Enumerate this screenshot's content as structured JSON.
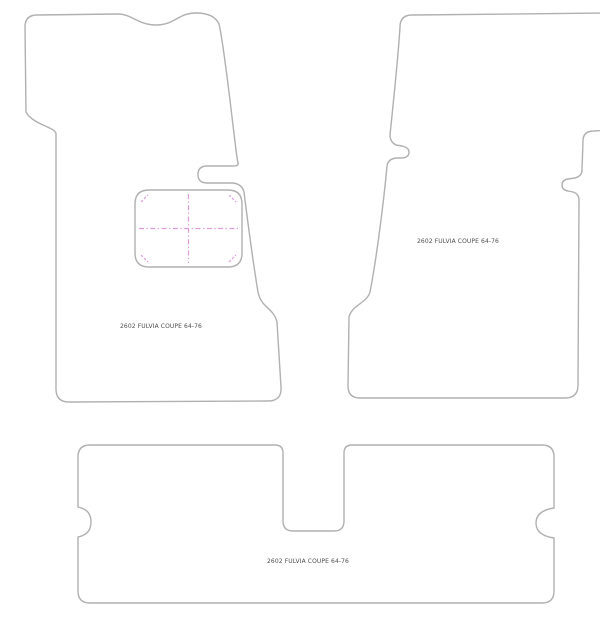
{
  "drawing": {
    "background_color": "#ffffff",
    "outline_color": "#b0b0b0",
    "marking_color": "#dd9add",
    "label_color": "#4d4d4d",
    "mats": {
      "front_left": {
        "label": "2602 FULVIA COUPE 64-76",
        "outline_path": "M 26,112 L 25,27 Q 25,15 37,15 L 118,14 C 132,14 138,25 156,25 C 175,25 178,13 196,13 Q 214,13 219,24 C 224,45 231,110 236,150 Q 237,158 238,163 Q 239,166 233,166 L 207,166 Q 198,166 198,174.5 Q 198,183 207,183 L 233,183 Q 242,184 244,192 C 248,224 253,262 258,292 C 261,308 273,307 277,322 L 281,387 Q 282,401 268,401 L 69,402 Q 56,402 56,389 L 56,134 C 56,127 33,125 26,112 Z",
        "heel_pad_path": "M 149,190 L 228,190 Q 242,190 242,204 L 242,253 Q 242,267 228,267 L 149,267 Q 135,267 135,253 L 135,204 Q 135,190 149,190 Z",
        "heel_pad_cross_path": "M 188.5,194 L 188.5,263 M 139,228.5 L 238,228.5",
        "heel_pad_tick_path": "M 141,202 L 148,195 M 229,195 L 236,202 M 141,255 L 148,262 M 229,262 L 236,255"
      },
      "front_right": {
        "label": "2602 FULVIA COUPE 64-76",
        "outline_path": "M 610,13 L 412,15 Q 400,15 400,27 C 398,60 392,115 390,135 Q 390,142 396,145 L 402,146 Q 409,147.5 409,152 Q 409,157.5 402,158 L 396,158 Q 388,159 387,166 C 384,200 376,262 370,292 C 367,303 352,305 349,317 L 348,386 Q 348,398 360,398 L 565,398 Q 578,398 578,385 L 579,200 Q 579,194 573,192 L 568,191 Q 562,190 562,185 Q 562,180 568,179 L 575,178 Q 582,176 582,170 L 583,141 Q 583,131 594,131 L 620,129 L 620,13 Z"
      },
      "rear": {
        "label": "2602 FULVIA COUPE 64-76",
        "outline_path": "M 90,445 L 275,445 Q 283,445 283,453 L 283,521 Q 283,531 293,531 L 334,531 Q 344,531 344,521 L 344,453 Q 344,445 352,445 L 542,445 Q 554,445 554,457 L 554,508 C 540,510 536,516 536,523 C 536,530 540,536 554,538 L 554,591 Q 554,603 542,603 L 90,603 Q 78,603 78,591 L 78,537 C 88,535 91,529 91,522 C 91,515 88,509 78,507 L 78,457 Q 78,445 90,445 Z"
      }
    }
  }
}
